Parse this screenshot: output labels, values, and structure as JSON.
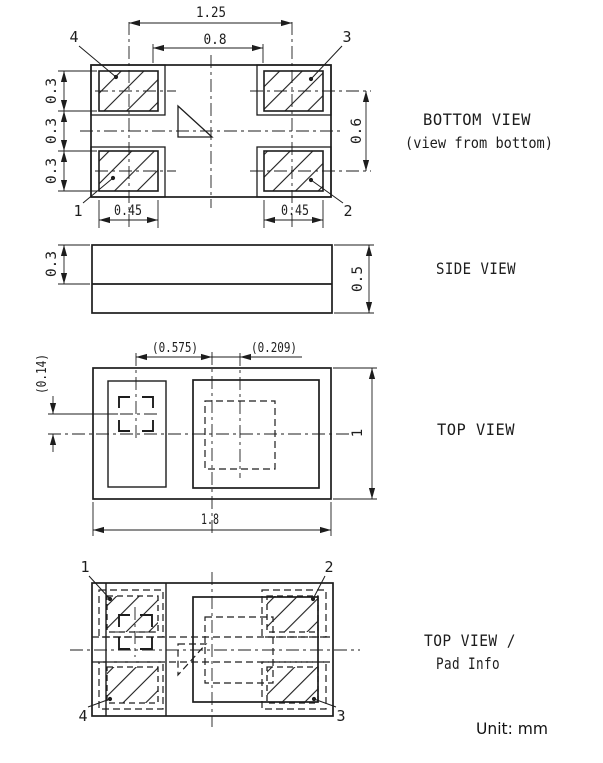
{
  "note": "Unit: mm",
  "colors": {
    "line": "#1d1d1d",
    "background": "#ffffff"
  },
  "views": {
    "bottom": {
      "title": "BOTTOM VIEW",
      "subtitle": "(view from bottom)",
      "pad_numbers": {
        "top_left": "4",
        "top_right": "3",
        "bottom_left": "1",
        "bottom_right": "2"
      },
      "dims": {
        "pad_pitch_x": "1.25",
        "pad_gap_x": "0.8",
        "pad_height_top": "0.3",
        "pad_gap_y": "0.3",
        "pad_height_bottom": "0.3",
        "pad_pitch_y": "0.6",
        "pad_width_left": "0.45",
        "pad_width_right": "0.45"
      }
    },
    "side": {
      "title": "SIDE VIEW",
      "dims": {
        "top_part": "0.3",
        "total": "0.5"
      }
    },
    "top": {
      "title": "TOP VIEW",
      "dims": {
        "offset_x1": "(0.575)",
        "offset_x2": "(0.209)",
        "offset_y": "(0.14)",
        "height_val": "1",
        "width_val": "1.8"
      }
    },
    "pad_info": {
      "title_line1": "TOP VIEW /",
      "title_line2": "Pad Info",
      "pad_numbers": {
        "top_left": "1",
        "top_right": "2",
        "bottom_left": "4",
        "bottom_right": "3"
      }
    }
  }
}
